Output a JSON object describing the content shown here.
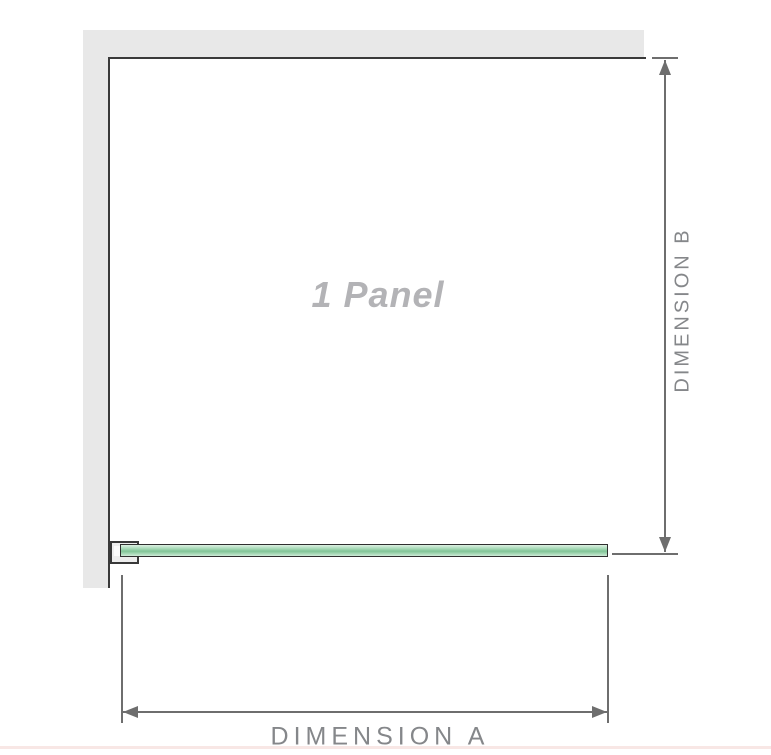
{
  "diagram": {
    "panel_label": "1 Panel",
    "dimension_a_label": "DIMENSION A",
    "dimension_b_label": "DIMENSION B"
  },
  "colors": {
    "wall_gray": "#e8e8e8",
    "edge_dark": "#3a3a3a",
    "dimension_line_gray": "#6e6e6e",
    "dimension_label_gray": "#85878a",
    "panel_label_gray": "#b3b3b6",
    "glass_green": "#93cfa6",
    "glass_green_light": "#ddf0e2",
    "glass_border": "#2f2f2f",
    "bracket_fill": "#ededed",
    "bottom_divider_pink": "#f8e7e5"
  }
}
